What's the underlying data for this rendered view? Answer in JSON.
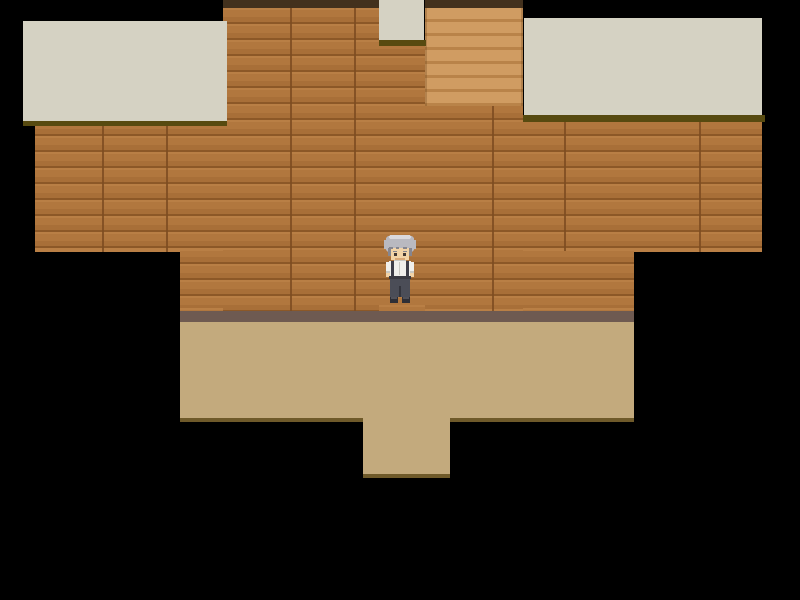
{
  "app": {
    "type": "rpg-game-scene",
    "description": "Top-down pixel-art RPG interior: wooden plank walls, cream ceiling/roof tiles, a staircase alcove, tan floor with a doorway opening at the bottom, and an elderly gray-haired character standing at the center. No visible text or HUD.",
    "viewport": {
      "width": 800,
      "height": 600
    }
  },
  "palette": {
    "background": "#000000",
    "roof_cream": "#d5d2c3",
    "roof_shadow": "#574a10",
    "wall_base": "#b1773e",
    "wall_light": "#b97f45",
    "wall_dark": "#a86f38",
    "wall_seam": "#8c5827",
    "wall_top_edge": "#43311d",
    "stairs_light": "#d09c62",
    "stairs_dark": "#b98349",
    "baseboard": "#6e5a51",
    "floor": "#c3aa7d",
    "floor_edge": "#6f5a2a"
  },
  "scene": {
    "regions": [
      {
        "name": "wall-upper-band",
        "kind": "wall",
        "x": 35,
        "y": 122,
        "w": 727,
        "h": 130,
        "interactable": false
      },
      {
        "name": "wall-lower-band",
        "kind": "wall",
        "x": 180,
        "y": 251,
        "w": 454,
        "h": 60,
        "interactable": false
      },
      {
        "name": "wall-center-column",
        "kind": "wall",
        "x": 223,
        "y": 8,
        "w": 156,
        "h": 303,
        "interactable": false
      },
      {
        "name": "wall-below-small-roof",
        "kind": "wall",
        "x": 379,
        "y": 46,
        "w": 46,
        "h": 265,
        "interactable": false
      },
      {
        "name": "wall-below-stairs",
        "kind": "wall",
        "x": 425,
        "y": 106,
        "w": 98,
        "h": 205,
        "interactable": false
      },
      {
        "name": "stairs-up",
        "kind": "stairs",
        "x": 425,
        "y": 8,
        "w": 98,
        "h": 98,
        "interactable": true
      },
      {
        "name": "wall-top-edge-left",
        "kind": "topedge",
        "x": 223,
        "y": 0,
        "w": 156,
        "h": 8,
        "interactable": false
      },
      {
        "name": "wall-top-edge-right",
        "kind": "topedge",
        "x": 425,
        "y": 0,
        "w": 98,
        "h": 8,
        "interactable": false
      },
      {
        "name": "roof-left",
        "kind": "roof",
        "x": 23,
        "y": 21,
        "w": 204,
        "h": 100,
        "interactable": false
      },
      {
        "name": "roof-left-shadow",
        "kind": "shadow",
        "x": 23,
        "y": 121,
        "w": 204,
        "h": 5,
        "interactable": false
      },
      {
        "name": "roof-right",
        "kind": "roof",
        "x": 524,
        "y": 18,
        "w": 238,
        "h": 97,
        "interactable": false
      },
      {
        "name": "roof-right-shadow",
        "kind": "shadow",
        "x": 523,
        "y": 115,
        "w": 242,
        "h": 7,
        "interactable": false
      },
      {
        "name": "roof-small-center",
        "kind": "roof",
        "x": 379,
        "y": 0,
        "w": 45,
        "h": 40,
        "interactable": false
      },
      {
        "name": "roof-small-center-shadow",
        "kind": "shadow",
        "x": 379,
        "y": 40,
        "w": 47,
        "h": 6,
        "interactable": false
      },
      {
        "name": "baseboard-strip",
        "kind": "strip",
        "x": 180,
        "y": 311,
        "w": 454,
        "h": 11,
        "interactable": false
      },
      {
        "name": "floor-main",
        "kind": "floor",
        "x": 180,
        "y": 322,
        "w": 454,
        "h": 96,
        "interactable": true
      },
      {
        "name": "floor-edge-left",
        "kind": "flooredge",
        "x": 180,
        "y": 418,
        "w": 183,
        "h": 4,
        "interactable": false
      },
      {
        "name": "floor-edge-right",
        "kind": "flooredge",
        "x": 450,
        "y": 418,
        "w": 184,
        "h": 4,
        "interactable": false
      },
      {
        "name": "floor-doorway",
        "kind": "floor",
        "x": 363,
        "y": 418,
        "w": 87,
        "h": 56,
        "interactable": true
      },
      {
        "name": "floor-doorway-edge",
        "kind": "flooredge",
        "x": 363,
        "y": 474,
        "w": 87,
        "h": 4,
        "interactable": false
      }
    ]
  },
  "character": {
    "name": "elderly-man-player",
    "facing": "down",
    "x": 381,
    "y": 234,
    "width": 38,
    "height": 72,
    "colors": {
      "hair": "#b9b9c0",
      "hair_light": "#d9d9de",
      "hair_dark": "#86868f",
      "skin": "#f2d3a7",
      "skin_shadow": "#d9a878",
      "eye": "#433734",
      "shirt": "#f0efeb",
      "shirt_shadow": "#c9c8c2",
      "suspenders": "#3d3d47",
      "belt": "#3a3a42",
      "pants": "#4b4d57",
      "pants_dark": "#34353d",
      "shoes": "#2f2f36",
      "shoe_light": "#52525a"
    }
  }
}
